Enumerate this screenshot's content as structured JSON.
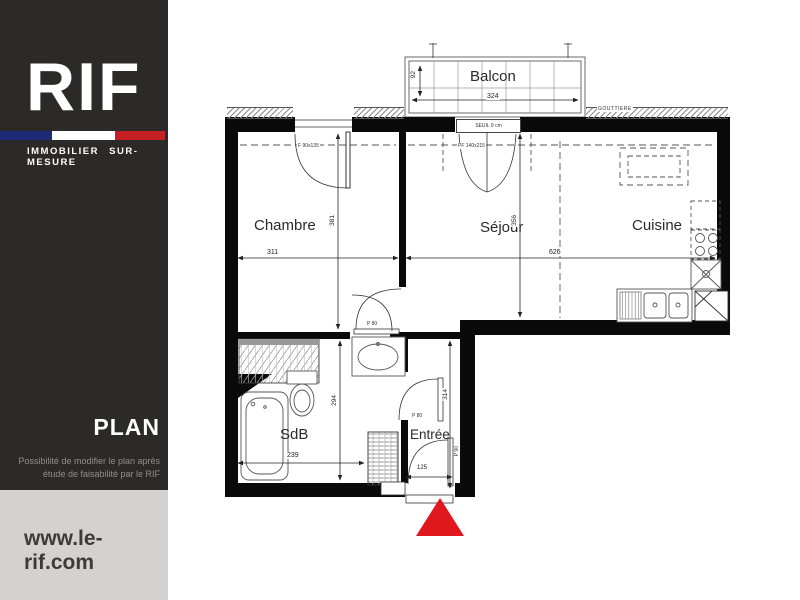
{
  "sidebar": {
    "brand": "RIF",
    "tagline": "IMMOBILIER SUR-MESURE",
    "section_label": "PLAN",
    "note_line1": "Possibilité de modifier le plan après",
    "note_line2": "étude de faisabilité par le RIF",
    "website": "www.le-rif.com",
    "colors": {
      "panel_dark": "#2b2a29",
      "panel_light": "#d3d2d0",
      "flag_blue": "#1e2a78",
      "flag_red": "#c52026"
    }
  },
  "plan": {
    "rooms": {
      "balcon": "Balcon",
      "chambre": "Chambre",
      "sejour": "Séjour",
      "cuisine": "Cuisine",
      "sdb": "SdB",
      "entree": "Entrée"
    },
    "dims": {
      "balcon_w": "324",
      "balcon_d": "92",
      "chambre_w": "311",
      "chambre_h": "381",
      "sejour_w": "626",
      "sejour_h": "356",
      "sdb_w": "239",
      "sdb_h": "294",
      "entree_h": "314",
      "entree_w": "125"
    },
    "openings": {
      "chambre_window": "F 90x135",
      "sejour_door": "PF 140x215",
      "sdb_door": "P 80",
      "entree_door": "P 80",
      "front_door": "P 90",
      "seuil": "SEUIL 9 cm",
      "gouttiere": "GOUTTIERE"
    },
    "marker_color": "#e0171c"
  }
}
